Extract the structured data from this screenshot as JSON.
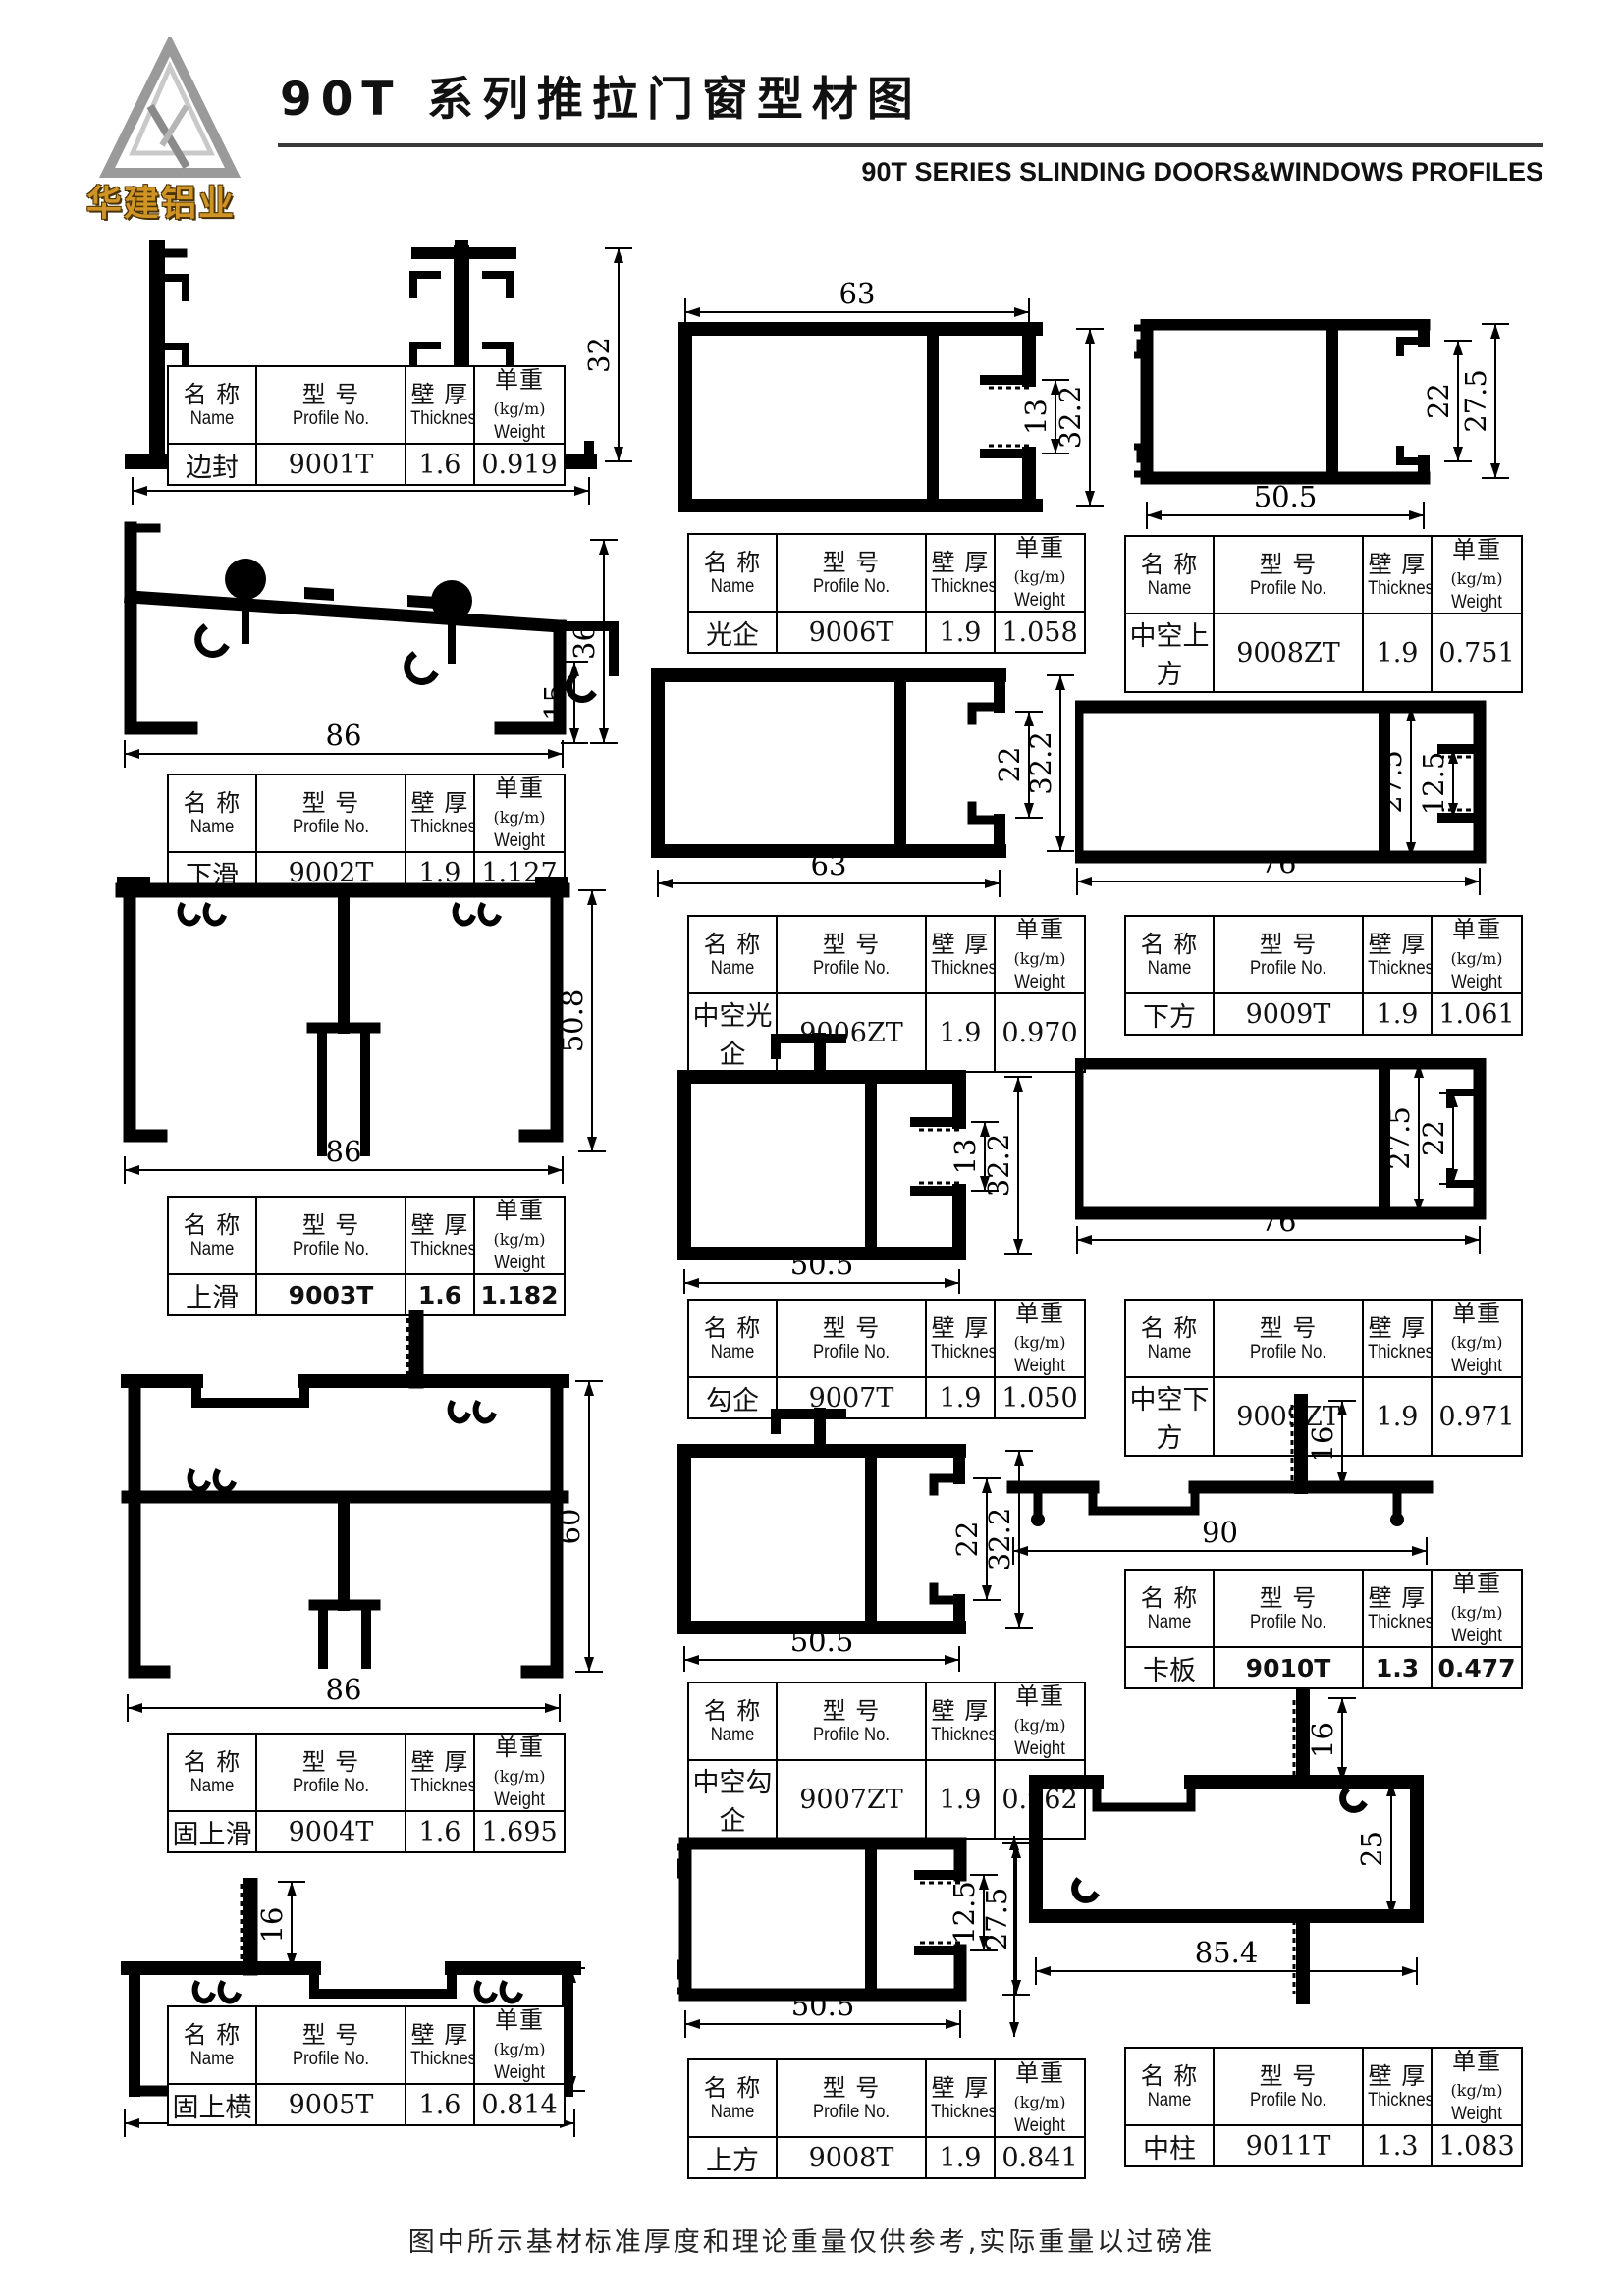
{
  "page": {
    "title": "90T 系列推拉门窗型材图",
    "subtitle_en": "90T SERIES SLINDING DOORS&WINDOWS PROFILES",
    "logo_text": "华建铝业",
    "footer_note": "图中所示基材标准厚度和理论重量仅供参考,实际重量以过磅准"
  },
  "table_header": {
    "name_cn": "名 称",
    "name_en": "Name",
    "model_cn": "型 号",
    "model_en": "Profile No.",
    "thickness_cn": "壁 厚",
    "thickness_en": "Thickness",
    "weight_cn": "单重",
    "weight_unit": "(kg/m)",
    "weight_en": "Weight"
  },
  "profiles": [
    {
      "name": "边封",
      "profile_no": "9001T",
      "thickness": "1.6",
      "weight": "0.919",
      "dims": [
        {
          "value": "90",
          "pos": "bottom"
        },
        {
          "value": "32",
          "pos": "right"
        }
      ]
    },
    {
      "name": "下滑",
      "profile_no": "9002T",
      "thickness": "1.9",
      "weight": "1.127",
      "dims": [
        {
          "value": "86",
          "pos": "bottom"
        },
        {
          "value": "36",
          "pos": "right"
        },
        {
          "value": "15",
          "pos": "right2"
        }
      ]
    },
    {
      "name": "上滑",
      "profile_no": "9003T",
      "thickness": "1.6",
      "weight": "1.182",
      "dims": [
        {
          "value": "86",
          "pos": "bottom"
        },
        {
          "value": "50.8",
          "pos": "right"
        }
      ]
    },
    {
      "name": "固上滑",
      "profile_no": "9004T",
      "thickness": "1.6",
      "weight": "1.695",
      "dims": [
        {
          "value": "86",
          "pos": "bottom"
        },
        {
          "value": "60",
          "pos": "right"
        }
      ]
    },
    {
      "name": "固上横",
      "profile_no": "9005T",
      "thickness": "1.6",
      "weight": "0.814",
      "dims": [
        {
          "value": "86",
          "pos": "bottom"
        },
        {
          "value": "25",
          "pos": "right"
        },
        {
          "value": "16",
          "pos": "topstem"
        }
      ]
    },
    {
      "name": "光企",
      "profile_no": "9006T",
      "thickness": "1.9",
      "weight": "1.058",
      "dims": [
        {
          "value": "63",
          "pos": "top"
        },
        {
          "value": "13",
          "pos": "right2"
        },
        {
          "value": "32.2",
          "pos": "right"
        }
      ]
    },
    {
      "name": "中空光企",
      "profile_no": "9006ZT",
      "thickness": "1.9",
      "weight": "0.970",
      "dims": [
        {
          "value": "63",
          "pos": "bottom"
        },
        {
          "value": "22",
          "pos": "right2"
        },
        {
          "value": "32.2",
          "pos": "right"
        }
      ]
    },
    {
      "name": "勾企",
      "profile_no": "9007T",
      "thickness": "1.9",
      "weight": "1.050",
      "dims": [
        {
          "value": "50.5",
          "pos": "bottom"
        },
        {
          "value": "13",
          "pos": "right2"
        },
        {
          "value": "32.2",
          "pos": "right"
        }
      ]
    },
    {
      "name": "中空勾企",
      "profile_no": "9007ZT",
      "thickness": "1.9",
      "weight": "0.962",
      "dims": [
        {
          "value": "50.5",
          "pos": "bottom"
        },
        {
          "value": "22",
          "pos": "right2"
        },
        {
          "value": "32.2",
          "pos": "right"
        }
      ]
    },
    {
      "name": "上方",
      "profile_no": "9008T",
      "thickness": "1.9",
      "weight": "0.841",
      "dims": [
        {
          "value": "50.5",
          "pos": "bottom"
        },
        {
          "value": "12.5",
          "pos": "right2"
        },
        {
          "value": "27.5",
          "pos": "right"
        }
      ]
    },
    {
      "name": "中空上方",
      "profile_no": "9008ZT",
      "thickness": "1.9",
      "weight": "0.751",
      "dims": [
        {
          "value": "50.5",
          "pos": "bottom"
        },
        {
          "value": "22",
          "pos": "right2"
        },
        {
          "value": "27.5",
          "pos": "right"
        }
      ]
    },
    {
      "name": "下方",
      "profile_no": "9009T",
      "thickness": "1.9",
      "weight": "1.061",
      "dims": [
        {
          "value": "76",
          "pos": "bottom"
        },
        {
          "value": "27.5",
          "pos": "right"
        },
        {
          "value": "12.5",
          "pos": "right2"
        }
      ]
    },
    {
      "name": "中空下方",
      "profile_no": "9009ZT",
      "thickness": "1.9",
      "weight": "0.971",
      "dims": [
        {
          "value": "76",
          "pos": "bottom"
        },
        {
          "value": "27.5",
          "pos": "right"
        },
        {
          "value": "22",
          "pos": "right2"
        }
      ]
    },
    {
      "name": "卡板",
      "profile_no": "9010T",
      "thickness": "1.3",
      "weight": "0.477",
      "dims": [
        {
          "value": "90",
          "pos": "bottom"
        },
        {
          "value": "16",
          "pos": "topstem"
        }
      ]
    },
    {
      "name": "中柱",
      "profile_no": "9011T",
      "thickness": "1.3",
      "weight": "1.083",
      "dims": [
        {
          "value": "85.4",
          "pos": "bottom"
        },
        {
          "value": "25",
          "pos": "right"
        },
        {
          "value": "16",
          "pos": "topstem"
        }
      ]
    }
  ]
}
